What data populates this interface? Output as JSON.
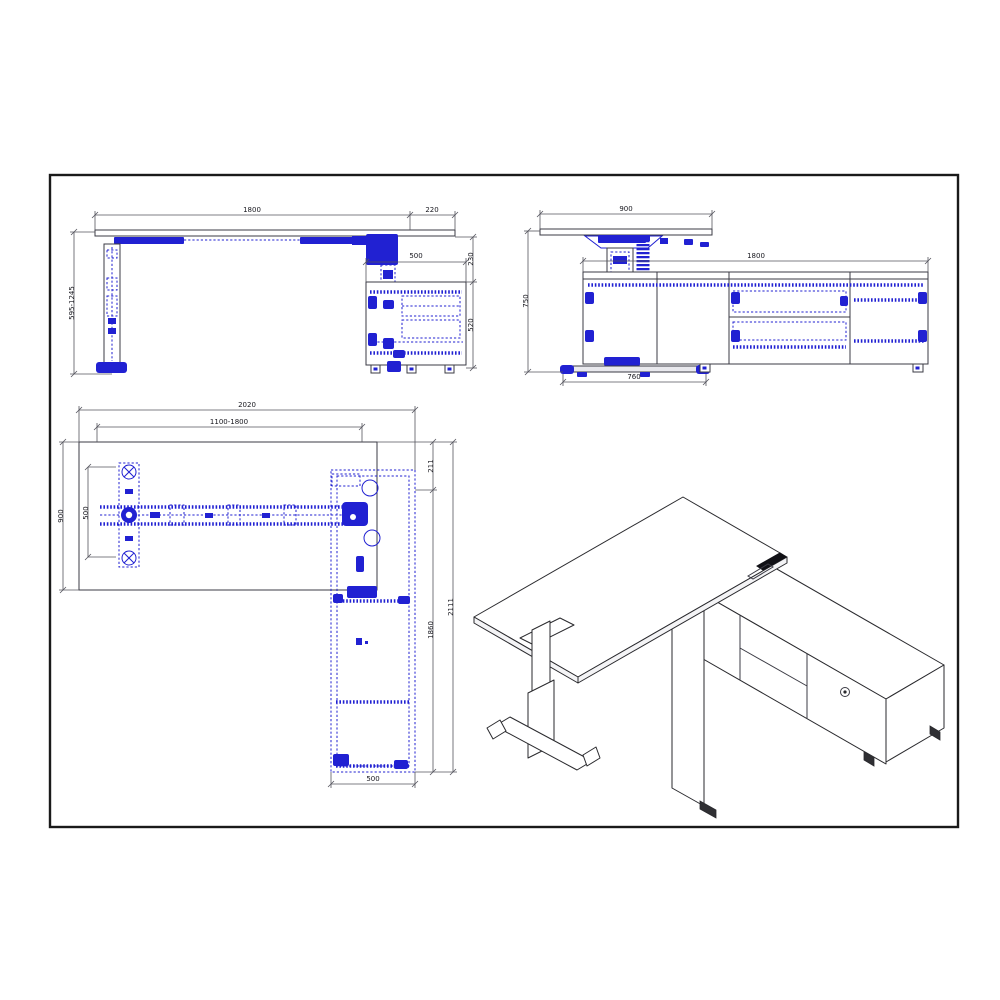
{
  "drawing": {
    "title": "height-adjustable l-desk with return cabinet technical drawing",
    "colors": {
      "hardware_blue": "#2121d2",
      "outline": "#3b3b44",
      "dimension": "#55555e",
      "frame": "#1a1a1a",
      "background": "#ffffff"
    },
    "views": {
      "front": {
        "dims": {
          "top_width": "1800",
          "top_overhang": "220",
          "cabinet_top_width": "500",
          "top_to_cabinet_gap": "230",
          "cabinet_height": "520",
          "height_range": "595-1245"
        }
      },
      "side": {
        "dims": {
          "top_depth": "900",
          "cabinet_length": "1800",
          "overall_height": "750",
          "foot_length": "760"
        }
      },
      "plan": {
        "dims": {
          "overall_length": "2020",
          "adjustable_span": "1100-1800",
          "top_depth": "900",
          "foot_span": "500",
          "corner_offset": "211",
          "return_length": "1860",
          "overall_depth": "2111",
          "return_width": "500"
        }
      }
    }
  }
}
